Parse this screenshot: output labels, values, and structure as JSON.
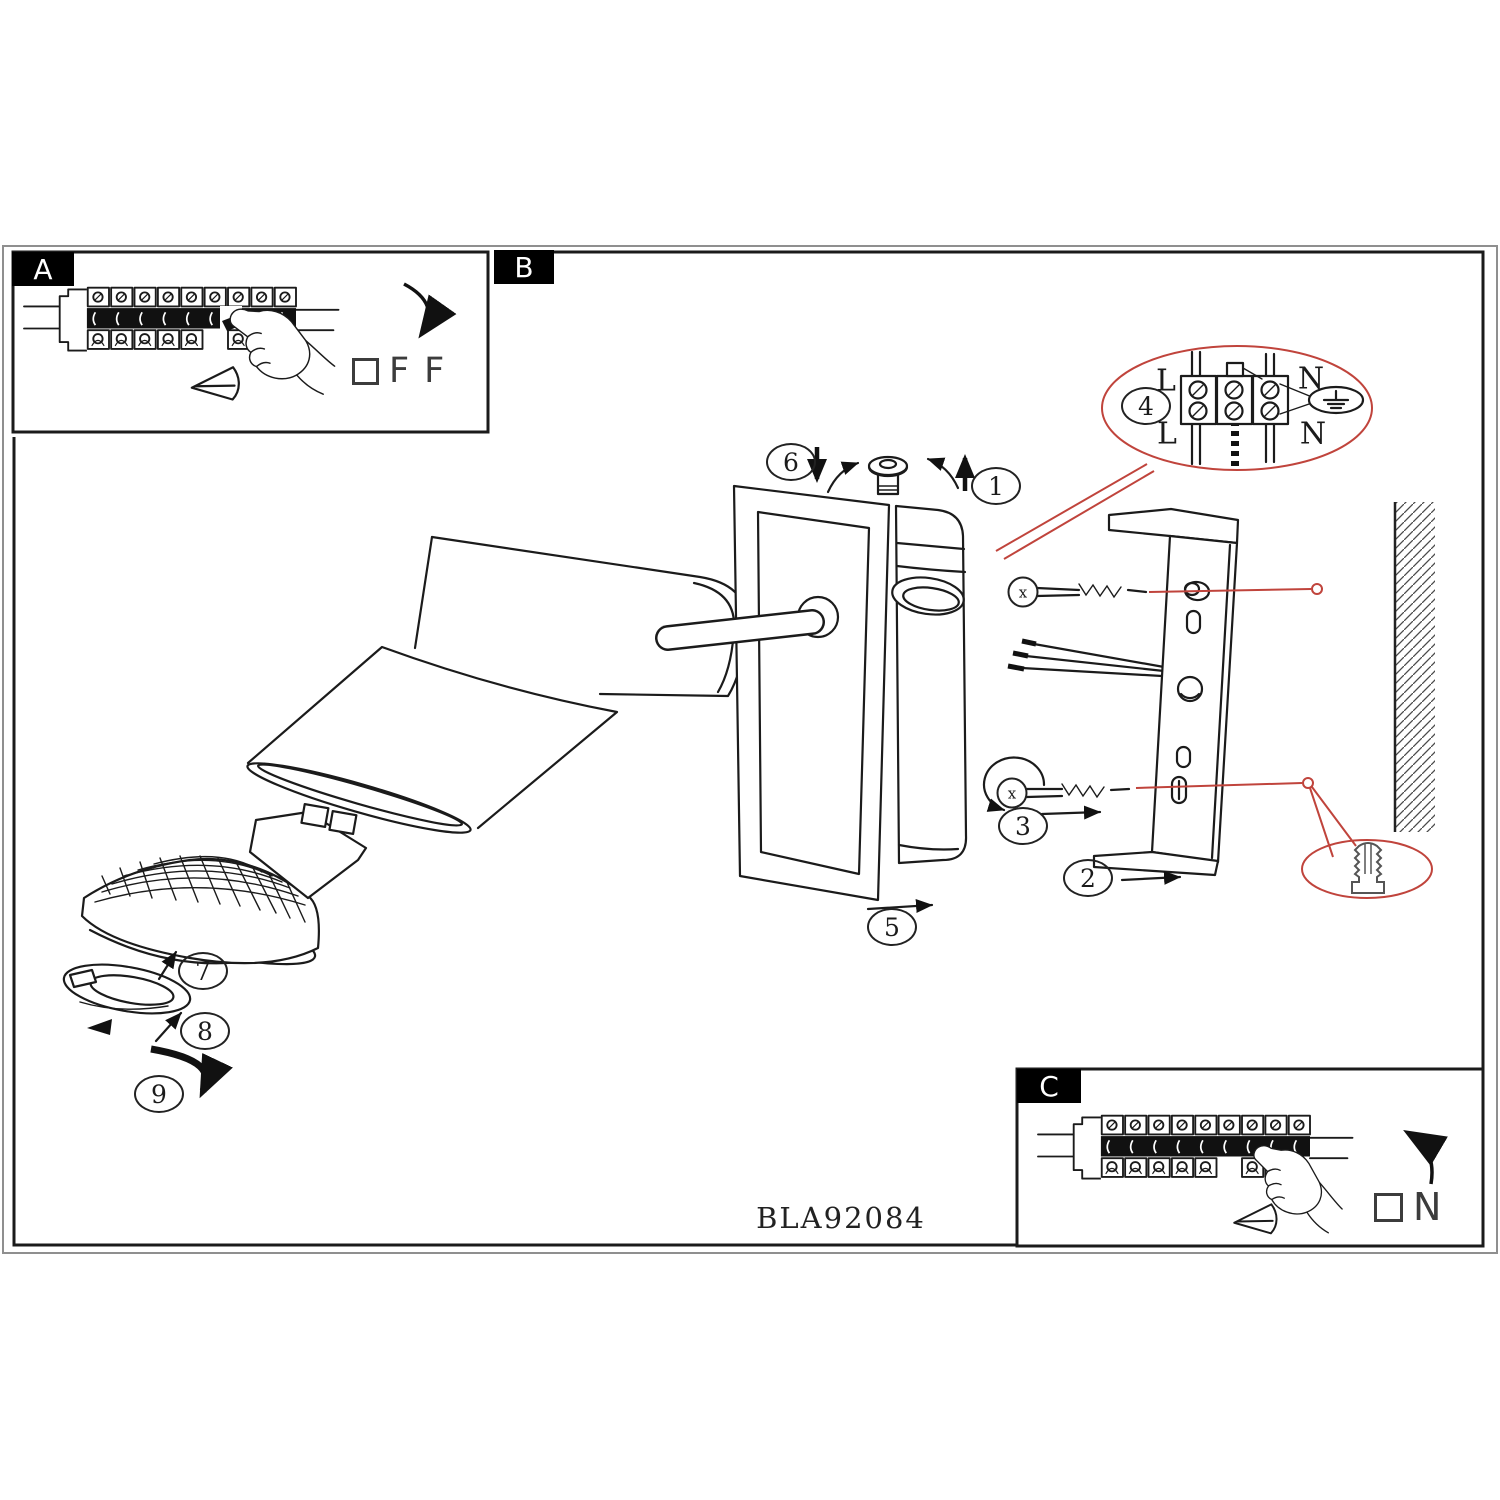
{
  "product_code": "BLA92084",
  "panels": {
    "a": {
      "label": "A",
      "switch_state": "FF"
    },
    "b": {
      "label": "B"
    },
    "c": {
      "label": "C",
      "switch_state": "N"
    }
  },
  "steps": [
    "1",
    "2",
    "3",
    "4",
    "5",
    "6",
    "7",
    "8",
    "9"
  ],
  "wiring": {
    "live_top": "L",
    "live_bottom": "L",
    "neutral_top": "N",
    "neutral_bottom": "N"
  },
  "screws": {
    "upper": "x",
    "lower": "x"
  },
  "colors": {
    "ink": "#1b1b1b",
    "callout_red": "#c0443c"
  }
}
